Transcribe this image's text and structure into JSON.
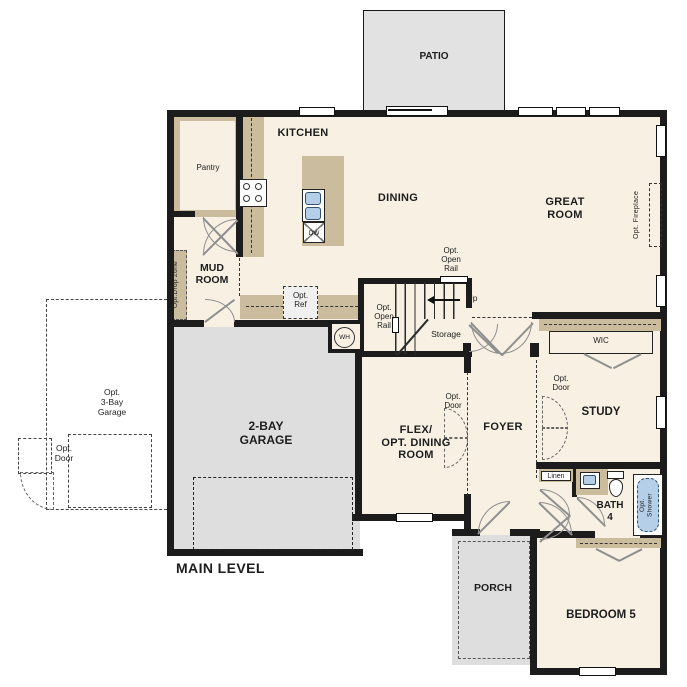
{
  "title": "MAIN LEVEL",
  "rooms": {
    "patio": "PATIO",
    "kitchen": "KITCHEN",
    "dining": "DINING",
    "great_room": "GREAT\nROOM",
    "pantry": "Pantry",
    "mud_room": "MUD\nROOM",
    "garage": "2-BAY\nGARAGE",
    "flex": "FLEX/\nOPT. DINING\nROOM",
    "foyer": "FOYER",
    "study": "STUDY",
    "wic": "WIC",
    "bath": "BATH\n4",
    "bedroom": "BEDROOM 5",
    "porch": "PORCH",
    "storage": "Storage",
    "linen": "Linen"
  },
  "annotations": {
    "opt_open_rail_upper": "Opt.\nOpen\nRail",
    "opt_open_rail_lower": "Opt.\nOpen\nRail",
    "up": "Up",
    "opt_ref": "Opt.\nRef",
    "opt_drop_zone": "Opt.Drop Zone",
    "opt_fireplace": "Opt. Fireplace",
    "opt_door_flex": "Opt.\nDoor",
    "opt_door_study": "Opt.\nDoor",
    "opt_door_garage": "Opt.\nDoor",
    "opt_3bay_garage": "Opt.\n3-Bay\nGarage",
    "opt_shower": "Opt.\nShower"
  },
  "fixtures": {
    "wh": "WH",
    "dw": "DW"
  },
  "colors": {
    "floor": "#f7f0e3",
    "wall": "#1c1c1c",
    "cabinet": "#cbbc9e",
    "concrete": "#dedede",
    "fixture_blue": "#b5cfe9"
  }
}
